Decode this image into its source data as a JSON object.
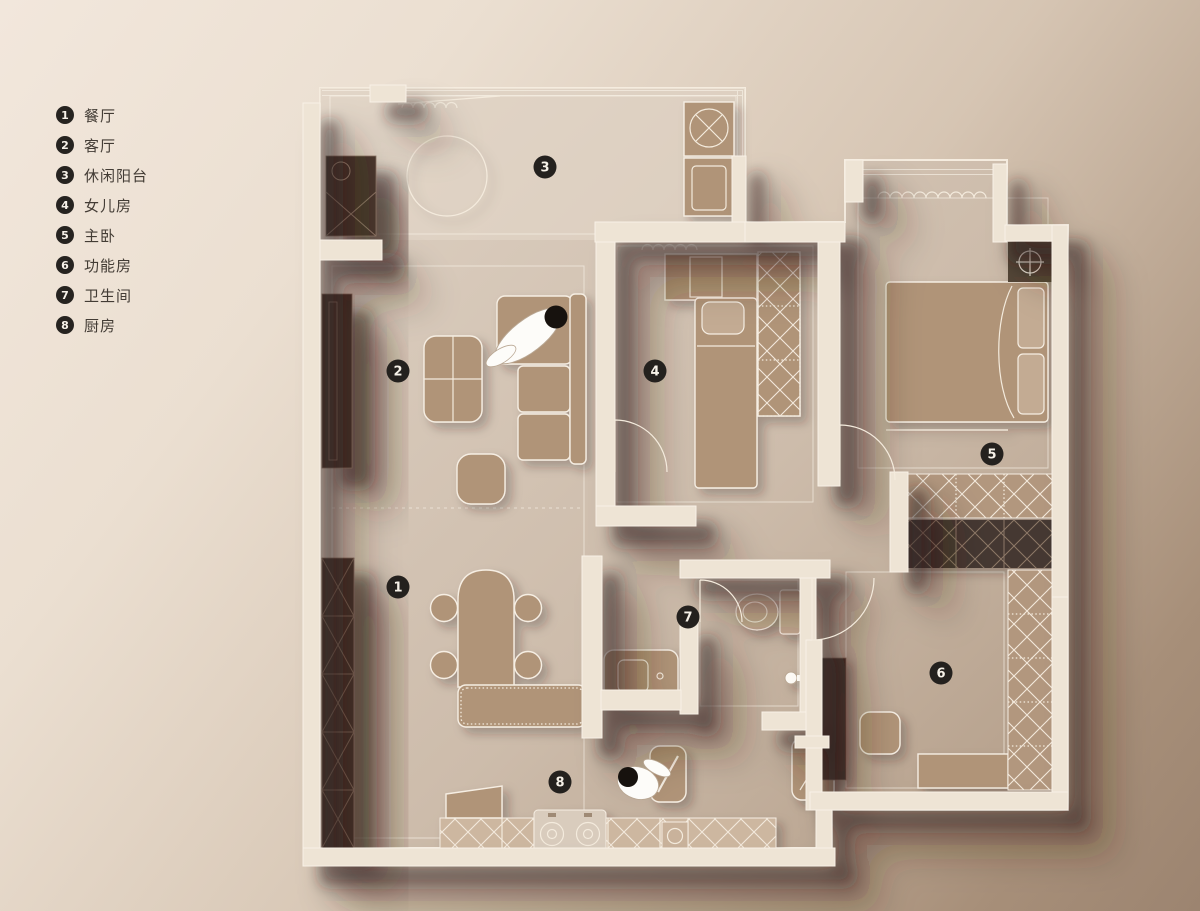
{
  "legend": {
    "items": [
      {
        "number": "1",
        "label": "餐厅"
      },
      {
        "number": "2",
        "label": "客厅"
      },
      {
        "number": "3",
        "label": "休闲阳台"
      },
      {
        "number": "4",
        "label": "女儿房"
      },
      {
        "number": "5",
        "label": "主卧"
      },
      {
        "number": "6",
        "label": "功能房"
      },
      {
        "number": "7",
        "label": "卫生间"
      },
      {
        "number": "8",
        "label": "厨房"
      }
    ]
  },
  "floorplan": {
    "room_markers": [
      {
        "number": "1",
        "label": "餐厅",
        "x": 398,
        "y": 587
      },
      {
        "number": "2",
        "label": "客厅",
        "x": 398,
        "y": 371
      },
      {
        "number": "3",
        "label": "休闲阳台",
        "x": 545,
        "y": 167
      },
      {
        "number": "4",
        "label": "女儿房",
        "x": 655,
        "y": 371
      },
      {
        "number": "5",
        "label": "主卧",
        "x": 992,
        "y": 454
      },
      {
        "number": "6",
        "label": "功能房",
        "x": 941,
        "y": 673
      },
      {
        "number": "7",
        "label": "卫生间",
        "x": 688,
        "y": 617
      },
      {
        "number": "8",
        "label": "厨房",
        "x": 560,
        "y": 782
      }
    ],
    "figures": [
      {
        "name": "person-lying-on-sofa"
      },
      {
        "name": "person-cooking-at-counter"
      }
    ]
  },
  "colors": {
    "background_top_left": "#f2e7dc",
    "background_bottom_right": "#9c8470",
    "wall": "#eee4d5",
    "floor_light": "#ddd0c2",
    "floor_dark": "#b59f8a",
    "furniture": "#b09478",
    "cabinet_dark": "#46392f",
    "hatch_line": "#f3e9dc",
    "badge": "#24211e",
    "legend_text": "#433c35"
  }
}
